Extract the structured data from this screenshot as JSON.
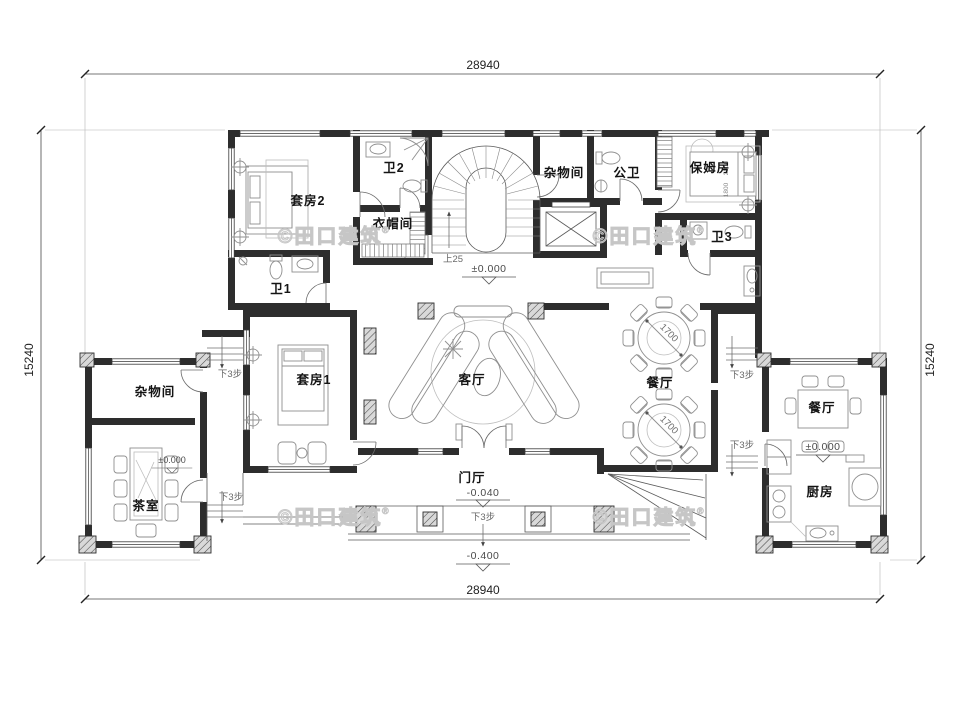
{
  "drawing": {
    "watermark": "©田口建筑",
    "watermark_reg": "®"
  },
  "dimensions": {
    "overall_width": "28940",
    "overall_height": "15240"
  },
  "rooms": {
    "suite2": "套房2",
    "bath2": "卫2",
    "cloakroom": "衣帽间",
    "bath1": "卫1",
    "storage_upper": "杂物间",
    "public_bath": "公卫",
    "nanny_room": "保姆房",
    "bath3": "卫3",
    "suite1": "套房1",
    "living_room": "客厅",
    "dining_room": "餐厅",
    "storage_west": "杂物间",
    "tea_room": "茶室",
    "dining_east": "餐厅",
    "kitchen": "厨房",
    "foyer": "门厅"
  },
  "levels": {
    "zero": "±0.000",
    "foyer": "-0.040",
    "ground": "-0.400"
  },
  "notes": {
    "stair_up": "上25",
    "steps_down": "下3步",
    "table_diameter": "1700",
    "bed_width": "1800",
    "bed_length": "2000"
  }
}
